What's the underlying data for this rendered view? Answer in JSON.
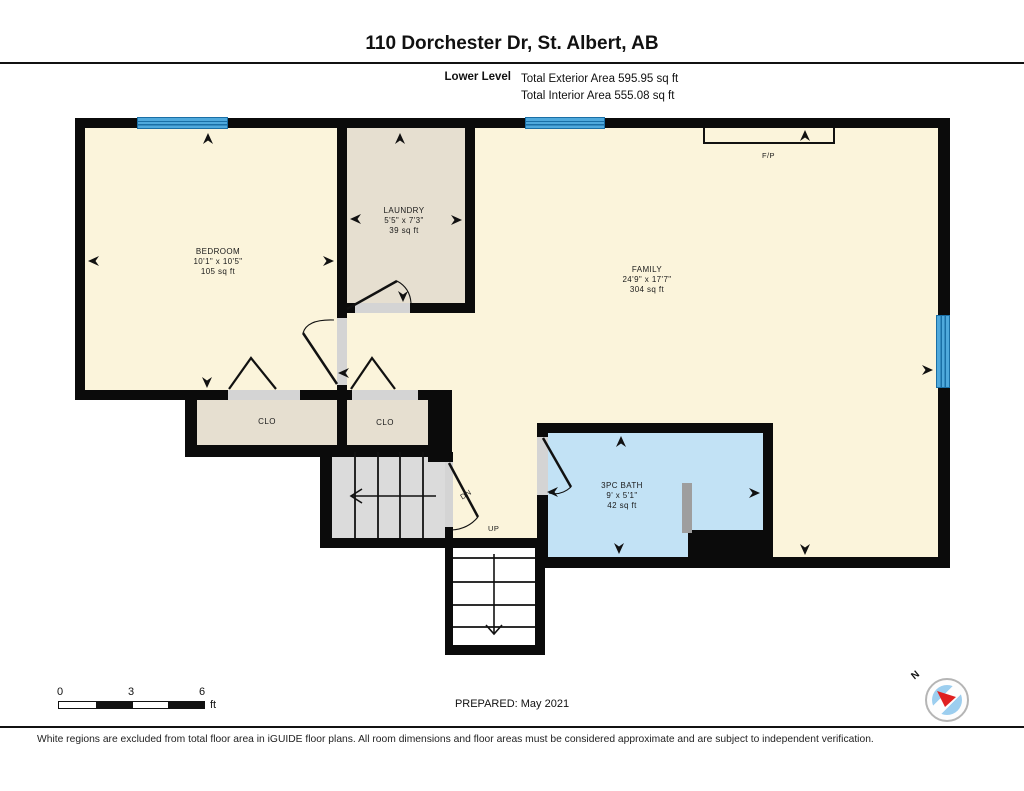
{
  "header": {
    "title": "110 Dorchester Dr, St. Albert, AB",
    "level_label": "Lower Level",
    "exterior_area": "Total Exterior Area 595.95 sq ft",
    "interior_area": "Total Interior Area 555.08 sq ft"
  },
  "rooms": [
    {
      "name": "BEDROOM",
      "dimensions": "10'1\" x 10'5\"",
      "area": "105 sq ft"
    },
    {
      "name": "LAUNDRY",
      "dimensions": "5'5\" x 7'3\"",
      "area": "39 sq ft"
    },
    {
      "name": "FAMILY",
      "dimensions": "24'9\" x 17'7\"",
      "area": "304 sq ft"
    },
    {
      "name": "3PC BATH",
      "dimensions": "9' x 5'1\"",
      "area": "42 sq ft"
    }
  ],
  "labels": {
    "closet1": "CLO",
    "closet2": "CLO",
    "fireplace": "F/P",
    "stairs_down": "DN",
    "stairs_up": "UP",
    "north": "N"
  },
  "scale_bar": {
    "tick0": "0",
    "tick1": "3",
    "tick2": "6",
    "unit": "ft"
  },
  "prepared": "PREPARED: May 2021",
  "disclaimer": "White regions are excluded from total floor area in iGUIDE floor plans. All room dimensions and floor areas must be considered approximate and are subject to independent verification.",
  "colors": {
    "floor_cream": "#fbf4db",
    "floor_tan": "#e6dfd0",
    "floor_bath_blue": "#c2e2f5",
    "stair_gray": "#dbdbdb",
    "window_blue": "#4fa9dc",
    "wall_black": "#0b0b0b",
    "compass_red": "#e02020"
  }
}
